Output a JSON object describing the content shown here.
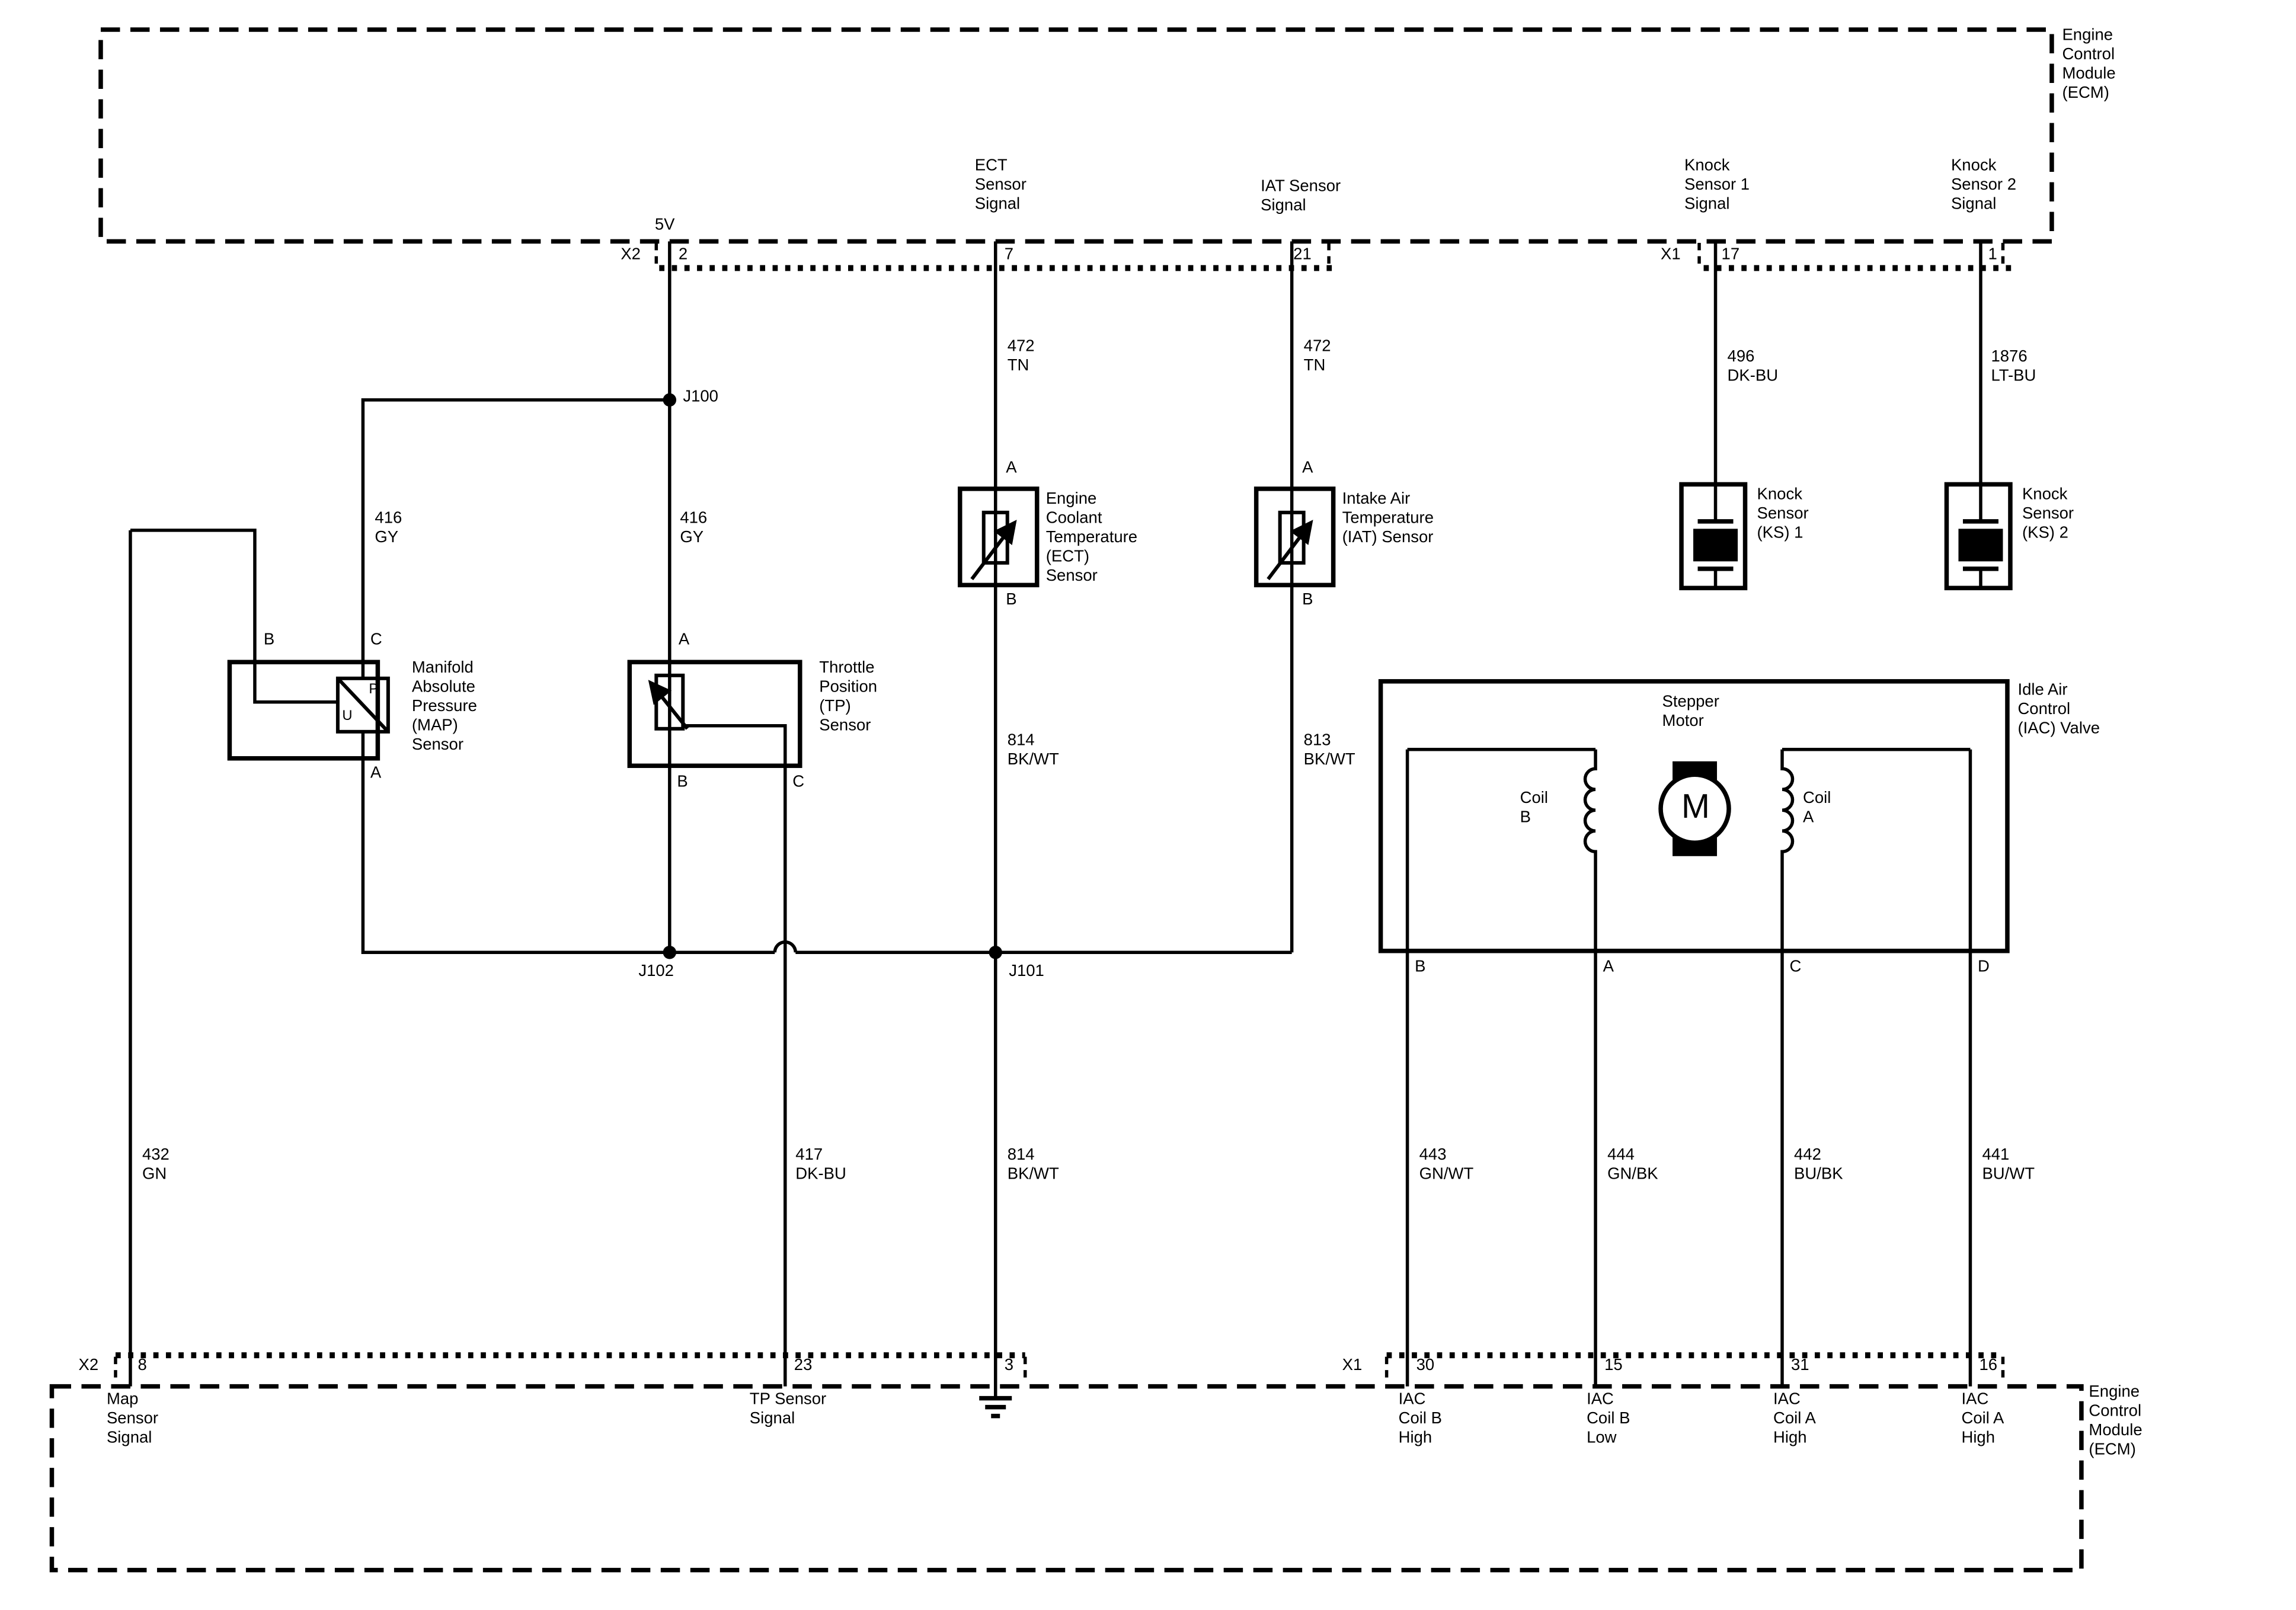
{
  "colors": {
    "ink": "#000000",
    "paper": "#ffffff"
  },
  "ecm_top": {
    "name": "Engine\nControl\nModule\n(ECM)",
    "signals": {
      "v5": "5V",
      "ect": "ECT\nSensor\nSignal",
      "iat": "IAT Sensor\nSignal",
      "ks1": "Knock\nSensor 1\nSignal",
      "ks2": "Knock\nSensor 2\nSignal"
    },
    "connector_x2": "X2",
    "connector_x1": "X1",
    "pin_2": "2",
    "pin_7": "7",
    "pin_21": "21",
    "pin_17": "17",
    "pin_1": "1"
  },
  "wires": {
    "w416_map": "416\nGY",
    "w416_tp": "416\nGY",
    "w472_ect": "472\nTN",
    "w472_iat": "472\nTN",
    "w496": "496\nDK-BU",
    "w1876": "1876\nLT-BU",
    "w814_upper": "814\nBK/WT",
    "w813": "813\nBK/WT",
    "w432": "432\nGN",
    "w417": "417\nDK-BU",
    "w814_lower": "814\nBK/WT",
    "w443": "443\nGN/WT",
    "w444": "444\nGN/BK",
    "w442": "442\nBU/BK",
    "w441": "441\nBU/WT"
  },
  "junctions": {
    "j100": "J100",
    "j101": "J101",
    "j102": "J102"
  },
  "map_sensor": {
    "label": "Manifold\nAbsolute\nPressure\n(MAP)\nSensor",
    "pin_a": "A",
    "pin_b": "B",
    "pin_c": "C",
    "p": "P",
    "u": "U"
  },
  "tp_sensor": {
    "label": "Throttle\nPosition\n(TP)\nSensor",
    "pin_a": "A",
    "pin_b": "B",
    "pin_c": "C"
  },
  "ect_sensor": {
    "label": "Engine\nCoolant\nTemperature\n(ECT)\nSensor",
    "pin_a": "A",
    "pin_b": "B"
  },
  "iat_sensor": {
    "label": "Intake Air\nTemperature\n(IAT) Sensor",
    "pin_a": "A",
    "pin_b": "B"
  },
  "ks1": {
    "label": "Knock\nSensor\n(KS) 1"
  },
  "ks2": {
    "label": "Knock\nSensor\n(KS) 2"
  },
  "iac": {
    "label": "Idle Air\nControl\n(IAC) Valve",
    "stepper": "Stepper\nMotor",
    "motor": "M",
    "coil_b": "Coil\nB",
    "coil_a": "Coil\nA",
    "pin_b": "B",
    "pin_a": "A",
    "pin_c": "C",
    "pin_d": "D"
  },
  "ecm_bottom": {
    "name": "Engine\nControl\nModule\n(ECM)",
    "connector_x2": "X2",
    "connector_x1": "X1",
    "pin_8": "8",
    "pin_23": "23",
    "pin_3": "3",
    "pin_30": "30",
    "pin_15": "15",
    "pin_31": "31",
    "pin_16": "16",
    "signals": {
      "map": "Map\nSensor\nSignal",
      "tp": "TP Sensor\nSignal",
      "iac_b_high": "IAC\nCoil B\nHigh",
      "iac_b_low": "IAC\nCoil B\nLow",
      "iac_a_high": "IAC\nCoil A\nHigh",
      "iac_a_high2": "IAC\nCoil A\nHigh"
    }
  }
}
